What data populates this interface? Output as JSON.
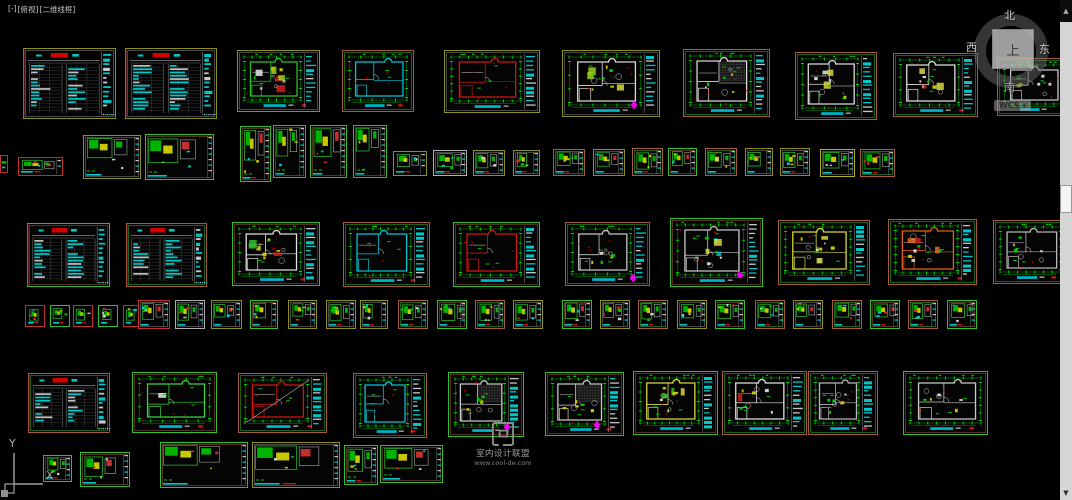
{
  "viewport": {
    "controls": "[-]",
    "view": "[俯视]",
    "style": "[二维线框]"
  },
  "viewcube": {
    "north": "北",
    "south": "南",
    "east": "东",
    "west": "西",
    "top": "上",
    "wcs": "WCS"
  },
  "icons": {
    "wcs_dropdown": "▾",
    "scroll_up": "▲",
    "scroll_down": "▼"
  },
  "watermark": {
    "line1": "室内设计联盟",
    "line2": "www.cool-de.com"
  },
  "ucs": {
    "y_label": "Y",
    "x_label": "X"
  },
  "colors": {
    "background": "#000000",
    "dim_green": "#00a400",
    "bright_green": "#00d000",
    "cyan": "#00c8c8",
    "red": "#d40000",
    "yellow": "#c8c800",
    "magenta": "#ee00ee",
    "sheet_olive": "#8f8f1e",
    "sheet_salmon": "#a85a40",
    "sheet_green": "#2fbf2f"
  },
  "sheets": [
    {
      "x": 23,
      "y": 48,
      "w": 93,
      "h": 71,
      "t": "table",
      "b": "#8f8f1e"
    },
    {
      "x": 125,
      "y": 48,
      "w": 92,
      "h": 71,
      "t": "table",
      "b": "#8f8f1e"
    },
    {
      "x": 237,
      "y": 50,
      "w": 83,
      "h": 62,
      "t": "plan",
      "b": "#8f8f1e",
      "wall": "#2fbf2f",
      "fills": [
        "#cf2020",
        "#e8e8e8",
        "#9fd020"
      ],
      "sb": true,
      "furn": true
    },
    {
      "x": 342,
      "y": 50,
      "w": 72,
      "h": 62,
      "t": "plan",
      "b": "#a85a40",
      "wall": "#00c4d4"
    },
    {
      "x": 444,
      "y": 50,
      "w": 96,
      "h": 63,
      "t": "plan",
      "b": "#8f8f1e",
      "wall": "#cf1414",
      "sb": true
    },
    {
      "x": 562,
      "y": 50,
      "w": 98,
      "h": 67,
      "t": "plan",
      "b": "#8f8f1e",
      "wall": "#d8d8d8",
      "fills": [
        "#9fd020",
        "#d8d840"
      ],
      "furn": true,
      "sb": true,
      "dm": [
        634,
        105
      ]
    },
    {
      "x": 683,
      "y": 49,
      "w": 87,
      "h": 68,
      "t": "plan",
      "b": "#a85a40",
      "wall": "#d8d8d8",
      "grid": true,
      "furn": true,
      "sb": true
    },
    {
      "x": 795,
      "y": 52,
      "w": 82,
      "h": 68,
      "t": "plan",
      "b": "#a85a40",
      "wall": "#dcdcdc",
      "fills": [
        "#d8d840",
        "#e8e8e8"
      ],
      "furn": true,
      "sb": true
    },
    {
      "x": 893,
      "y": 53,
      "w": 85,
      "h": 64,
      "t": "plan",
      "b": "#a85a40",
      "wall": "#e0e0e0",
      "fills": [
        "#cf2020",
        "#d8d840"
      ],
      "furn": true,
      "sb": true
    },
    {
      "x": 997,
      "y": 58,
      "w": 72,
      "h": 58,
      "t": "plan",
      "b": "#a85a40",
      "wall": "#c8c8c8",
      "furn": true
    },
    {
      "x": 0,
      "y": 155,
      "w": 8,
      "h": 18,
      "t": "detail",
      "b": "#c03030"
    },
    {
      "x": 18,
      "y": 157,
      "w": 45,
      "h": 19,
      "t": "detail",
      "b": "#c03030"
    },
    {
      "x": 83,
      "y": 135,
      "w": 58,
      "h": 44,
      "t": "detail",
      "b": "#8f8f1e"
    },
    {
      "x": 145,
      "y": 134,
      "w": 69,
      "h": 46,
      "t": "detail",
      "b": "#2fbf2f"
    },
    {
      "x": 240,
      "y": 126,
      "w": 31,
      "h": 56,
      "t": "detail",
      "b": "#2fbf2f"
    },
    {
      "x": 273,
      "y": 125,
      "w": 33,
      "h": 53,
      "t": "detail",
      "b": "#2fbf2f"
    },
    {
      "x": 310,
      "y": 125,
      "w": 37,
      "h": 53,
      "t": "detail",
      "b": "#2fbf2f"
    },
    {
      "x": 353,
      "y": 125,
      "w": 34,
      "h": 53,
      "t": "detail",
      "b": "#2fbf2f"
    },
    {
      "x": 393,
      "y": 151,
      "w": 34,
      "h": 25,
      "t": "detail",
      "b": "#8f8f1e"
    },
    {
      "x": 433,
      "y": 150,
      "w": 34,
      "h": 26,
      "t": "detail",
      "b": "#b0b0b0"
    },
    {
      "x": 473,
      "y": 150,
      "w": 32,
      "h": 26,
      "t": "detail",
      "b": "#8f8f1e"
    },
    {
      "x": 513,
      "y": 150,
      "w": 27,
      "h": 26,
      "t": "detail",
      "b": "#8f8f1e"
    },
    {
      "x": 553,
      "y": 149,
      "w": 32,
      "h": 27,
      "t": "detail",
      "b": "#a85a40"
    },
    {
      "x": 593,
      "y": 149,
      "w": 32,
      "h": 27,
      "t": "detail",
      "b": "#8f8f1e"
    },
    {
      "x": 632,
      "y": 148,
      "w": 31,
      "h": 28,
      "t": "detail",
      "b": "#a85a40"
    },
    {
      "x": 668,
      "y": 148,
      "w": 29,
      "h": 28,
      "t": "detail",
      "b": "#2fbf2f"
    },
    {
      "x": 705,
      "y": 148,
      "w": 32,
      "h": 28,
      "t": "detail",
      "b": "#a85a40"
    },
    {
      "x": 745,
      "y": 148,
      "w": 28,
      "h": 28,
      "t": "detail",
      "b": "#8f8f1e"
    },
    {
      "x": 780,
      "y": 148,
      "w": 30,
      "h": 28,
      "t": "detail",
      "b": "#8f8f1e"
    },
    {
      "x": 820,
      "y": 149,
      "w": 35,
      "h": 28,
      "t": "detail",
      "b": "#b0b020"
    },
    {
      "x": 860,
      "y": 149,
      "w": 35,
      "h": 28,
      "t": "detail",
      "b": "#a85a40"
    },
    {
      "x": 27,
      "y": 223,
      "w": 83,
      "h": 64,
      "t": "table",
      "b": "#2fbf2f"
    },
    {
      "x": 126,
      "y": 223,
      "w": 81,
      "h": 64,
      "t": "table",
      "b": "#a85a40"
    },
    {
      "x": 232,
      "y": 222,
      "w": 88,
      "h": 64,
      "t": "plan",
      "b": "#2fbf2f",
      "wall": "#e0e0e0",
      "fills": [
        "#cf2020",
        "#d8d840",
        "#2fbf2f"
      ],
      "sb": true,
      "furn": true
    },
    {
      "x": 343,
      "y": 222,
      "w": 87,
      "h": 65,
      "t": "plan",
      "b": "#a85a40",
      "wall": "#00c4d4",
      "sb": true
    },
    {
      "x": 453,
      "y": 222,
      "w": 87,
      "h": 65,
      "t": "plan",
      "b": "#2fbf2f",
      "wall": "#cf1414",
      "sb": true
    },
    {
      "x": 565,
      "y": 222,
      "w": 85,
      "h": 64,
      "t": "plan",
      "b": "#a85a40",
      "wall": "#c8c8c8",
      "furn": true,
      "sb": true,
      "dm": [
        633,
        278
      ]
    },
    {
      "x": 670,
      "y": 218,
      "w": 93,
      "h": 69,
      "t": "plan",
      "b": "#2fbf2f",
      "wall": "#c8c8c8",
      "fills": [
        "#00c4d4",
        "#d8d840"
      ],
      "furn": true,
      "sb": true,
      "dot": [
        740,
        275
      ]
    },
    {
      "x": 778,
      "y": 220,
      "w": 92,
      "h": 65,
      "t": "plan",
      "b": "#a85a40",
      "wall": "#d8d840",
      "fills": [
        "#e8e860",
        "#d8d840"
      ],
      "furn": true,
      "sb": true
    },
    {
      "x": 888,
      "y": 219,
      "w": 89,
      "h": 66,
      "t": "plan",
      "b": "#a85a40",
      "wall": "#e06020",
      "fills": [
        "#cf2020",
        "#e07030"
      ],
      "furn": true,
      "sb": true
    },
    {
      "x": 993,
      "y": 220,
      "w": 75,
      "h": 64,
      "t": "plan",
      "b": "#a85a40",
      "wall": "#b8b8b8",
      "furn": true
    },
    {
      "x": 25,
      "y": 305,
      "w": 20,
      "h": 22,
      "t": "detail",
      "b": "#c03030"
    },
    {
      "x": 50,
      "y": 305,
      "w": 20,
      "h": 22,
      "t": "detail",
      "b": "#2fbf2f"
    },
    {
      "x": 73,
      "y": 305,
      "w": 20,
      "h": 22,
      "t": "detail",
      "b": "#c03030"
    },
    {
      "x": 98,
      "y": 305,
      "w": 20,
      "h": 22,
      "t": "detail",
      "b": "#2fbf2f"
    },
    {
      "x": 123,
      "y": 305,
      "w": 17,
      "h": 22,
      "t": "detail",
      "b": "#c03030"
    },
    {
      "x": 138,
      "y": 300,
      "w": 32,
      "h": 29,
      "t": "detail",
      "b": "#c03030"
    },
    {
      "x": 175,
      "y": 300,
      "w": 30,
      "h": 29,
      "t": "detail",
      "b": "#b0b0b0"
    },
    {
      "x": 211,
      "y": 300,
      "w": 31,
      "h": 29,
      "t": "detail",
      "b": "#8f8f1e"
    },
    {
      "x": 250,
      "y": 300,
      "w": 28,
      "h": 29,
      "t": "detail",
      "b": "#2fbf2f"
    },
    {
      "x": 288,
      "y": 300,
      "w": 29,
      "h": 29,
      "t": "detail",
      "b": "#8f8f1e"
    },
    {
      "x": 326,
      "y": 300,
      "w": 30,
      "h": 29,
      "t": "detail",
      "b": "#8f8f1e"
    },
    {
      "x": 360,
      "y": 300,
      "w": 28,
      "h": 29,
      "t": "detail",
      "b": "#8f8f1e"
    },
    {
      "x": 398,
      "y": 300,
      "w": 30,
      "h": 29,
      "t": "detail",
      "b": "#a85a40"
    },
    {
      "x": 437,
      "y": 300,
      "w": 30,
      "h": 29,
      "t": "detail",
      "b": "#2fbf2f"
    },
    {
      "x": 475,
      "y": 300,
      "w": 30,
      "h": 29,
      "t": "detail",
      "b": "#a85a40"
    },
    {
      "x": 513,
      "y": 300,
      "w": 30,
      "h": 29,
      "t": "detail",
      "b": "#8f8f1e"
    },
    {
      "x": 562,
      "y": 300,
      "w": 30,
      "h": 29,
      "t": "detail",
      "b": "#2fbf2f"
    },
    {
      "x": 600,
      "y": 300,
      "w": 30,
      "h": 29,
      "t": "detail",
      "b": "#8f8f1e"
    },
    {
      "x": 638,
      "y": 300,
      "w": 30,
      "h": 29,
      "t": "detail",
      "b": "#a85a40"
    },
    {
      "x": 677,
      "y": 300,
      "w": 30,
      "h": 29,
      "t": "detail",
      "b": "#8f8f1e"
    },
    {
      "x": 715,
      "y": 300,
      "w": 30,
      "h": 29,
      "t": "detail",
      "b": "#2fbf2f"
    },
    {
      "x": 755,
      "y": 300,
      "w": 30,
      "h": 29,
      "t": "detail",
      "b": "#a85a40"
    },
    {
      "x": 793,
      "y": 300,
      "w": 30,
      "h": 29,
      "t": "detail",
      "b": "#8f8f1e"
    },
    {
      "x": 832,
      "y": 300,
      "w": 30,
      "h": 29,
      "t": "detail",
      "b": "#a85a40"
    },
    {
      "x": 870,
      "y": 300,
      "w": 30,
      "h": 29,
      "t": "detail",
      "b": "#2fbf2f"
    },
    {
      "x": 908,
      "y": 300,
      "w": 30,
      "h": 29,
      "t": "detail",
      "b": "#a85a40"
    },
    {
      "x": 947,
      "y": 300,
      "w": 30,
      "h": 29,
      "t": "detail",
      "b": "#2fbf2f"
    },
    {
      "x": 28,
      "y": 373,
      "w": 82,
      "h": 60,
      "t": "table",
      "b": "#a85a40"
    },
    {
      "x": 132,
      "y": 372,
      "w": 85,
      "h": 61,
      "t": "plan",
      "b": "#2fbf2f",
      "wall": "#3fd03f",
      "fills": [
        "#e8e8e8"
      ]
    },
    {
      "x": 238,
      "y": 373,
      "w": 89,
      "h": 60,
      "t": "plan",
      "b": "#a85a40",
      "wall": "#cf1414",
      "diag": true,
      "sb": true
    },
    {
      "x": 353,
      "y": 373,
      "w": 74,
      "h": 65,
      "t": "plan",
      "b": "#a85a40",
      "wall": "#00c4d4",
      "sb": true
    },
    {
      "x": 448,
      "y": 372,
      "w": 76,
      "h": 65,
      "t": "plan",
      "b": "#2fbf2f",
      "wall": "#c8c8c8",
      "grid": true,
      "furn": true,
      "sb": true,
      "dm": [
        507,
        427
      ]
    },
    {
      "x": 545,
      "y": 372,
      "w": 79,
      "h": 64,
      "t": "plan",
      "b": "#2fbf2f",
      "wall": "#c8c8c8",
      "grid": true,
      "furn": true,
      "sb": true,
      "dm": [
        597,
        425
      ]
    },
    {
      "x": 633,
      "y": 371,
      "w": 85,
      "h": 64,
      "t": "plan",
      "b": "#2fbf2f",
      "wall": "#d8d840",
      "fills": [
        "#d8d840",
        "#2fbf2f"
      ],
      "furn": true,
      "sb": true
    },
    {
      "x": 722,
      "y": 371,
      "w": 85,
      "h": 64,
      "t": "plan",
      "b": "#a85a40",
      "wall": "#e0e0e0",
      "fills": [
        "#cf2020"
      ],
      "furn": true,
      "sb": true
    },
    {
      "x": 808,
      "y": 371,
      "w": 70,
      "h": 64,
      "t": "plan",
      "b": "#a85a40",
      "wall": "#b8b8b8",
      "furn": true,
      "sb": true
    },
    {
      "x": 903,
      "y": 371,
      "w": 85,
      "h": 64,
      "t": "plan",
      "b": "#2fbf2f",
      "wall": "#c8c8c8",
      "furn": true
    },
    {
      "x": 43,
      "y": 455,
      "w": 29,
      "h": 27,
      "t": "detail",
      "b": "#2fbf2f"
    },
    {
      "x": 80,
      "y": 452,
      "w": 50,
      "h": 35,
      "t": "detail",
      "b": "#2fbf2f"
    },
    {
      "x": 160,
      "y": 442,
      "w": 88,
      "h": 46,
      "t": "detail",
      "b": "#2fbf2f"
    },
    {
      "x": 252,
      "y": 442,
      "w": 88,
      "h": 46,
      "t": "detail",
      "b": "#8f8f1e"
    },
    {
      "x": 344,
      "y": 445,
      "w": 34,
      "h": 40,
      "t": "detail",
      "b": "#2fbf2f"
    },
    {
      "x": 380,
      "y": 445,
      "w": 63,
      "h": 38,
      "t": "detail",
      "b": "#2fbf2f"
    }
  ]
}
